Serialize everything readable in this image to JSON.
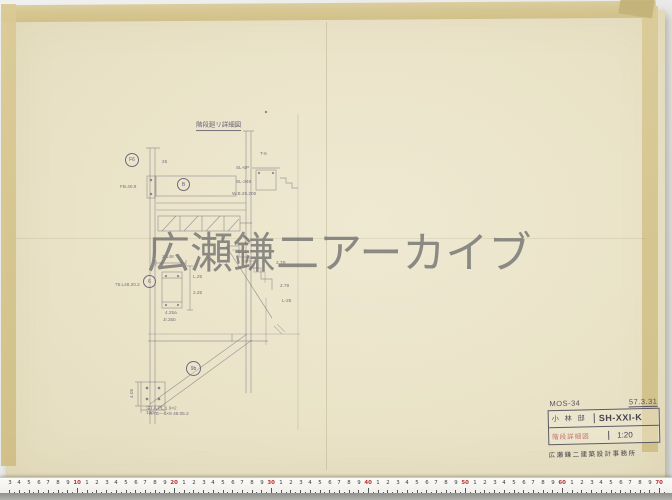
{
  "watermark": {
    "text": "広瀬鎌二アーカイブ"
  },
  "ruler": {
    "decade_labels": [
      "10",
      "20",
      "30",
      "40",
      "50",
      "60",
      "70"
    ]
  },
  "drawing": {
    "title": "階段廻リ詳細図",
    "labels": {
      "f6": "F6",
      "b": "B",
      "c6": "6",
      "n9b": "9b",
      "t6": "T-6"
    },
    "dims": {
      "d25": "25",
      "fb": "FB.40.9",
      "w2148": "2.148",
      "col": "75.L48.20.2",
      "l25": "L.25",
      "v225": "2.25",
      "a425": "4.25a",
      "jr": "Jr.25b",
      "sl6p": "SL-6P",
      "sl348": "SL-348",
      "wb": "W.B.25.200",
      "s17": "1.7",
      "s27b": "2.7B",
      "s278": "2.78",
      "sl25": "L-25",
      "h100": "100",
      "v405": "4.05"
    },
    "notes": {
      "line1": "注) A.PL 1.9×2",
      "line2": "A.7E—5×9 48.05.2"
    }
  },
  "title_block": {
    "code": "MOS-34",
    "date": "57.3.31",
    "client": "小 林 邸",
    "series": "SH-XXI-K",
    "stamp": "階段詳細図",
    "scale": "1:20",
    "office": "広瀬鎌二建築設計事務所"
  }
}
